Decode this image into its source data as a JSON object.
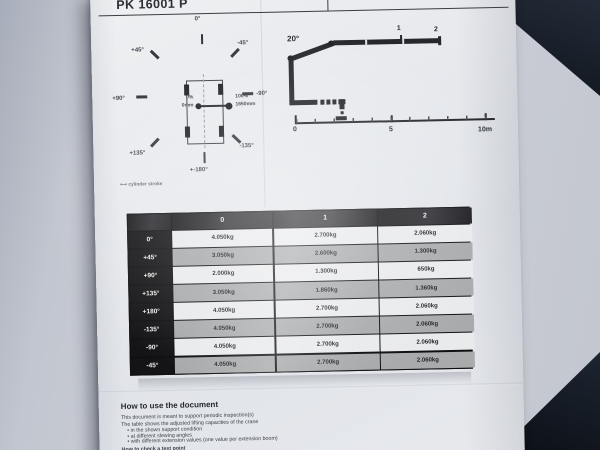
{
  "document": {
    "title": "PK 16001 P"
  },
  "rosette": {
    "labels": [
      {
        "text": "0°"
      },
      {
        "text": "+45°"
      },
      {
        "text": "-45°"
      },
      {
        "text": "+90°"
      },
      {
        "text": "-90°"
      },
      {
        "text": "+135°"
      },
      {
        "text": "-135°"
      },
      {
        "text": "+-180°"
      }
    ],
    "stabilizer": {
      "left_pct": "0%",
      "left_mm": "0mm",
      "right_pct": "100%",
      "right_mm": "1650mm"
    },
    "legend_symbol": "⟷",
    "legend": "cylinder stroke"
  },
  "boom": {
    "angle": "20°",
    "extension_1": "1",
    "extension_2": "2",
    "scale": {
      "t0": "0",
      "t5": "5",
      "t10": "10m"
    }
  },
  "table": {
    "columns": [
      "0",
      "1",
      "2"
    ],
    "rows": [
      {
        "angle": "0°",
        "v": [
          "4.050kg",
          "2.700kg",
          "2.060kg"
        ]
      },
      {
        "angle": "+45°",
        "v": [
          "3.050kg",
          "2.600kg",
          "1.300kg"
        ]
      },
      {
        "angle": "+90°",
        "v": [
          "2.000kg",
          "1.300kg",
          "650kg"
        ]
      },
      {
        "angle": "+135°",
        "v": [
          "3.050kg",
          "1.860kg",
          "1.360kg"
        ]
      },
      {
        "angle": "+180°",
        "v": [
          "4.050kg",
          "2.700kg",
          "2.060kg"
        ]
      },
      {
        "angle": "-135°",
        "v": [
          "4.050kg",
          "2.700kg",
          "2.060kg"
        ]
      },
      {
        "angle": "-90°",
        "v": [
          "4.050kg",
          "2.700kg",
          "2.060kg"
        ]
      },
      {
        "angle": "-45°",
        "v": [
          "4.050kg",
          "2.700kg",
          "2.060kg"
        ]
      }
    ]
  },
  "howto": {
    "title": "How to use the document",
    "line1": "This document is meant to support periodic inspection(s)",
    "line2": "The table shows the adjusted lifting capacities of the crane",
    "bullets": [
      "• in the shown support condition",
      "• at different slewing angles",
      "• with different extension values (one value per extension boom)"
    ],
    "footer": "How to check a test point"
  }
}
